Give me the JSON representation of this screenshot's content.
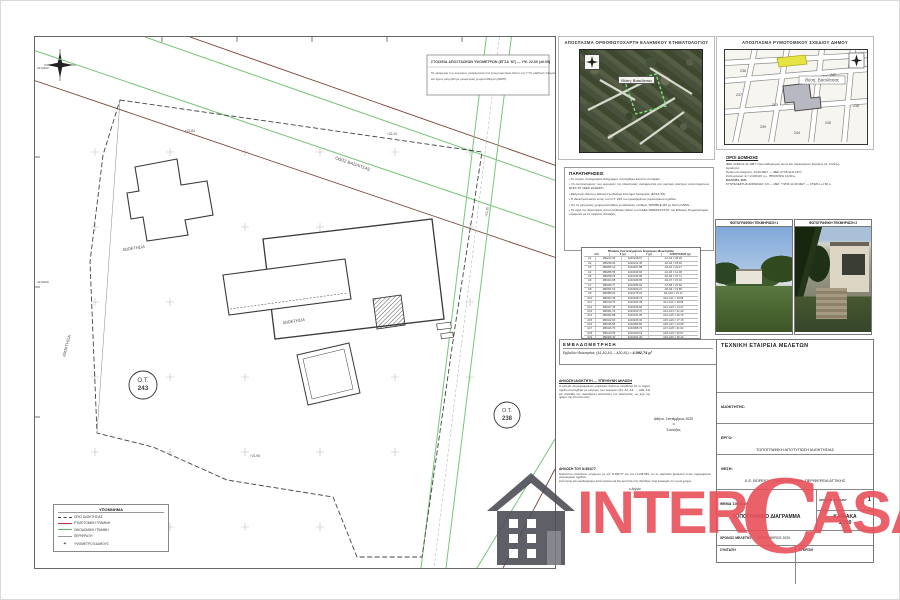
{
  "plan": {
    "note_box": {
      "title": "ΣΤΟΙΧΕΙΑ ΑΠΟΣΤΑΣΕΩΝ ΥΨΟΜΕΤΡΩΝ (ΕΓΣΑ '87) — ΥΨ. 22.00 (±0.05)",
      "body1": "Τα υψόμετρα των κορυφών αναφέρονται στο τριγωνομετρικό δίκτυο της ΓΥΣ («Εθνικό Υψομετρικό»)",
      "body2": "και έχουν μετρηθεί με γεωμετρική χωροστάθμηση (ΕΜΠ)."
    },
    "labels": {
      "ot243_line1": "Ο.Τ.",
      "ot243_line2": "243",
      "ot238_line1": "Ο.Τ.",
      "ot238_line2": "238",
      "idioktisia1": "ΙΔΙΟΚΤΗΣΙΑ",
      "idioktisia2": "ΙΔΙΟΚΤΗΣΙΑ",
      "idioktisia3": "ΙΔΙΟΚΤΗΣΙΑ",
      "road": "ΟΔΟΣ ΒΑΣΙΛΙΤΣΑΣ",
      "ele1": "+21.84",
      "ele2": "+22.10",
      "ele3": "+22.35",
      "ele4": "+21.96",
      "grid1": "4210400",
      "grid2": "4210200"
    },
    "legend": {
      "title": "ΥΠΟΜΝΗΜΑ",
      "items": [
        {
          "label": "ΟΡΙΟ ΙΔΙΟΚΤΗΣΙΑΣ"
        },
        {
          "label": "ΡΥΜΟΤΟΜΙΚΗ ΓΡΑΜΜΗ"
        },
        {
          "label": "ΟΙΚΟΔΟΜΙΚΗ ΓΡΑΜΜΗ"
        },
        {
          "label": "ΠΕΡΙΦΡΑΞΗ"
        },
        {
          "label": "ΥΨΟΜΕΤΡΟ ΕΔΑΦΟΥΣ"
        }
      ]
    }
  },
  "ortho_inset": {
    "title": "ΑΠΟΣΠΑΣΜΑ ΟΡΘΟΦΩΤΟΧΑΡΤΗ ΕΛΛΗΝΙΚΟΥ ΚΤΗΜΑΤΟΛΟΓΙΟΥ",
    "label": "Θέση: Βασιλίτσας"
  },
  "map_inset": {
    "title": "ΑΠΟΣΠΑΣΜΑ ΡΥΜΟΤΟΜΙΚΟΥ ΣΧΕΔΙΟΥ ΔΗΜΟΥ",
    "label": "Θέση: Βασιλίτσας",
    "block_numbers": [
      "236",
      "237",
      "238",
      "239",
      "240",
      "242",
      "243",
      "244"
    ]
  },
  "paratiriseis": {
    "title": "ΠΑΡΑΤΗΡΗΣΕΙΣ",
    "items": [
      "Το παρόν τοπογραφικό διάγραμμα συντάχθηκε κατόπιν αυτοψίας.",
      "Οι συντεταγμένες των κορυφών της ιδιοκτησίας αναφέρονται στο κρατικό σύστημα συντεταγμένων ΕΓΣΑ '87 (ΦΕΚ 223Δ/87).",
      "Εξάρτηση δικτύου: Εθνικό Γεωδαιτικό Σύστημα Αναφοράς (ΕΓΣΑ '87).",
      "Η ιδιοκτησία κείται εντός του Ο.Τ. 243 του εγκεκριμένου ρυμοτομικού σχεδίου.",
      "Για τις μετρήσεις χρησιμοποιήθηκε γεωδαιτικός σταθμός TRIMBLE M3 με δέκτη GNSS.",
      "Τα όρια της ιδιοκτησίας αποτυπώθηκαν βάσει του ΚΑΕΚ 05064ΧΧΧΧΧΧ του Εθνικού Κτηματολογίου, σύμφωνα με τις κείμενες διατάξεις."
    ]
  },
  "coords_table": {
    "title": "Πίνακας Συντεταγμένων Κορυφών Ιδιοκτησίας",
    "headers": [
      "Α/Α",
      "Χ (μ)",
      "Υ (μ)",
      "ΑΠΟΣΤΑΣΕΙΣ (μ)"
    ],
    "rows": [
      [
        "Α1",
        "480212.34",
        "4210218.67",
        "Α1-Α2 = 25.36"
      ],
      [
        "Α2",
        "480236.92",
        "4210212.45",
        "Α2-Α3 = 18.92"
      ],
      [
        "Α3",
        "480255.10",
        "4210207.88",
        "Α3-Α4 = 32.47"
      ],
      [
        "Α4",
        "480286.55",
        "4210199.93",
        "Α4-Α5 = 12.08"
      ],
      [
        "Α5",
        "480298.23",
        "4210196.90",
        "Α5-Α6 = 27.71"
      ],
      [
        "Α6",
        "480324.98",
        "4210189.95",
        "Α6-Α7 = 15.34"
      ],
      [
        "Α7",
        "480339.77",
        "4210186.02",
        "Α7-Α8 = 22.60"
      ],
      [
        "Α8",
        "480361.52",
        "4210180.21",
        "Α8-Α9 = 19.85"
      ],
      [
        "Α9",
        "480380.60",
        "4210175.04",
        "Α9-Α10 = 24.12"
      ],
      [
        "Α10",
        "480403.78",
        "4210168.73",
        "Α10-Α11 = 16.58"
      ],
      [
        "Α11",
        "480419.70",
        "4210164.35",
        "Α11-Α12 = 28.96"
      ],
      [
        "Α12",
        "480447.45",
        "4210156.60",
        "Α12-Α13 = 14.27"
      ],
      [
        "Α13",
        "480461.10",
        "4210152.70",
        "Α13-Α14 = 21.43"
      ],
      [
        "Α14",
        "480452.88",
        "4210131.05",
        "Α14-Α15 = 26.79"
      ],
      [
        "Α15",
        "480442.60",
        "4210106.32",
        "Α15-Α16 = 17.15"
      ],
      [
        "Α16",
        "480435.95",
        "4210090.50",
        "Α16-Α17 = 23.68"
      ],
      [
        "Α17",
        "480426.70",
        "4210068.72",
        "Α17-Α18 = 31.02"
      ],
      [
        "Α18",
        "480414.55",
        "4210040.18",
        "Α18-Α19 = 20.57"
      ],
      [
        "Α19",
        "480406.40",
        "4210021.30",
        "Α19-Α20 = 35.14"
      ],
      [
        "Α20",
        "480392.75",
        "4209988.90",
        "Α20-Α1 = 29.41"
      ]
    ],
    "footer": "Εμβαδόν (Α1,Α2,...,Α20,Α1)  Ε = 4.092,74 τ.μ."
  },
  "emvadometrisi": {
    "title": "ΕΜΒΑΔΟΜΕΤΡΗΣΗ",
    "formula": "Εμβαδόν Ιδιοκτησίας: (Α1,Α2,Α3,...,Α20,Α1) =",
    "value": "4.092,74 μ²"
  },
  "declaration": {
    "header": "ΔΗΛΩΣΗ ΙΔΙΟΚΤΗΤΗ — ΥΠΕΥΘΥΝΗ ΔΗΛΩΣΗ",
    "paragraph": "Ο κάτωθι υπογεγραμμένος μηχανικός δηλώνω υπεύθυνα ότι το παρόν σχέδιο συντάχθηκε με μέτρηση των κορυφών (Α1, Α2, Α3, ..., Α20, Α1) και αποδίδει την υφιστάμενη κατάσταση της ιδιοκτησίας, ως έχει την ημέρα της αποτύπωσης.",
    "date": "Αθήνα, Σεπτέμβριος 2020",
    "signer_pre": "ο",
    "signer": "Συντάξας"
  },
  "dilosi651": {
    "header": "ΔΗΛΩΣΗ ΤΟΥ Ν.651/77",
    "lines": [
      "Δηλώνεται υπεύθυνα, σύμφωνα με τον Ν.651/77 και τον Ν.1337/83, ότι το οικόπεδο βρίσκεται εντός εγκεκριμένου ρυμοτομικού σχεδίου,",
      "είναι άρτιο και οικοδομήσιμο κατά κανόνα και δεν εμπίπτει στις διατάξεις περί εισφοράς σε γη και χρήμα."
    ],
    "signer": "ο Δηλών"
  },
  "oroi": {
    "title": "ΟΡΟΙ ΔΟΜΗΣΗΣ",
    "lines": [
      "ΦΕΚ 223Δ/14.11.1987: Περί καθορισμού όρων και περιορισμών δόμησης (Δ. Αττικής).",
      "Αρτιότητα:",
      "Πρόσωπο ελάχιστο: 14.00 ΜΕΤ. — ΦΕΚ 277Δ/12.8.1977.",
      "Κατά κανόνα: Ε = 2.000,00 τ.μ., ΠΡΟΣΟΨΗ 10,00 μ.",
      "ΚΑΛΥΨΗ: 40%",
      "ΣΥΝΤΕΛΕΣΤΗΣ ΔΟΜΗΣΗΣ: 0,6 — ΜΕΓ. ΥΨΟΣ 11.00 ΜΕΤ. — ΣΤΕΓΗ +1.50 μ."
    ]
  },
  "photos": {
    "title1": "ΦΩΤΟΓΡΑΦΙΚΗ ΤΕΚΜΗΡΙΩΣΗ 1",
    "title2": "ΦΩΤΟΓΡΑΦΙΚΗ ΤΕΚΜΗΡΙΩΣΗ 2"
  },
  "title_block": {
    "company": "ΤΕΧΝΙΚΗ ΕΤΑΙΡΕΙΑ ΜΕΛΕΤΩΝ",
    "owner_label": "ΙΔΙΟΚΤΗΤΗΣ:",
    "ergo_label": "ΕΡΓΟ:",
    "ergo_value": "ΤΟΠΟΓΡΑΦΙΚΗ ΑΠΟΤΥΠΩΣΗ ΙΔΙΟΚΤΗΣΙΑΣ",
    "thesi_label": "ΘΕΣΗ:",
    "thesi_value": "Χ.Ε. ΒΟΡΕΙΟΥ ΤΟΜΕΑ ΑΘΗΝΩΝ, ΠΕΡΙΦΕΡΕΙΑ ΑΤΤΙΚΗΣ",
    "thema_label": "ΘΕΜΑ ΣΧΕΔΙΟΥ",
    "thema_value": "ΤΟΠΟΓΡΑΦΙΚΟ ΔΙΑΓΡΑΜΜΑ",
    "num_label": "ΑΡΙΘΜΟΣ ΣΧΕΔΙΟΥ",
    "num_value": "1",
    "scale_line1": "ΚΛΙΜΑΚΑ",
    "scale_line2": "1:200",
    "time_label": "ΧΡΟΝΟΣ ΜΕΛΕΤΗΣ",
    "time_value": "ΣΕΠΤΕΜΒΡΙΟΣ 2020",
    "col1": "ΣΥΝΤΑΞΗ",
    "col2": "ΕΓΚΡΙΣΗ"
  },
  "watermark": {
    "inter": "INTER",
    "c": "C",
    "asa": "ASA",
    "red": "#e8505a",
    "house_gray": "#4e4e58"
  }
}
